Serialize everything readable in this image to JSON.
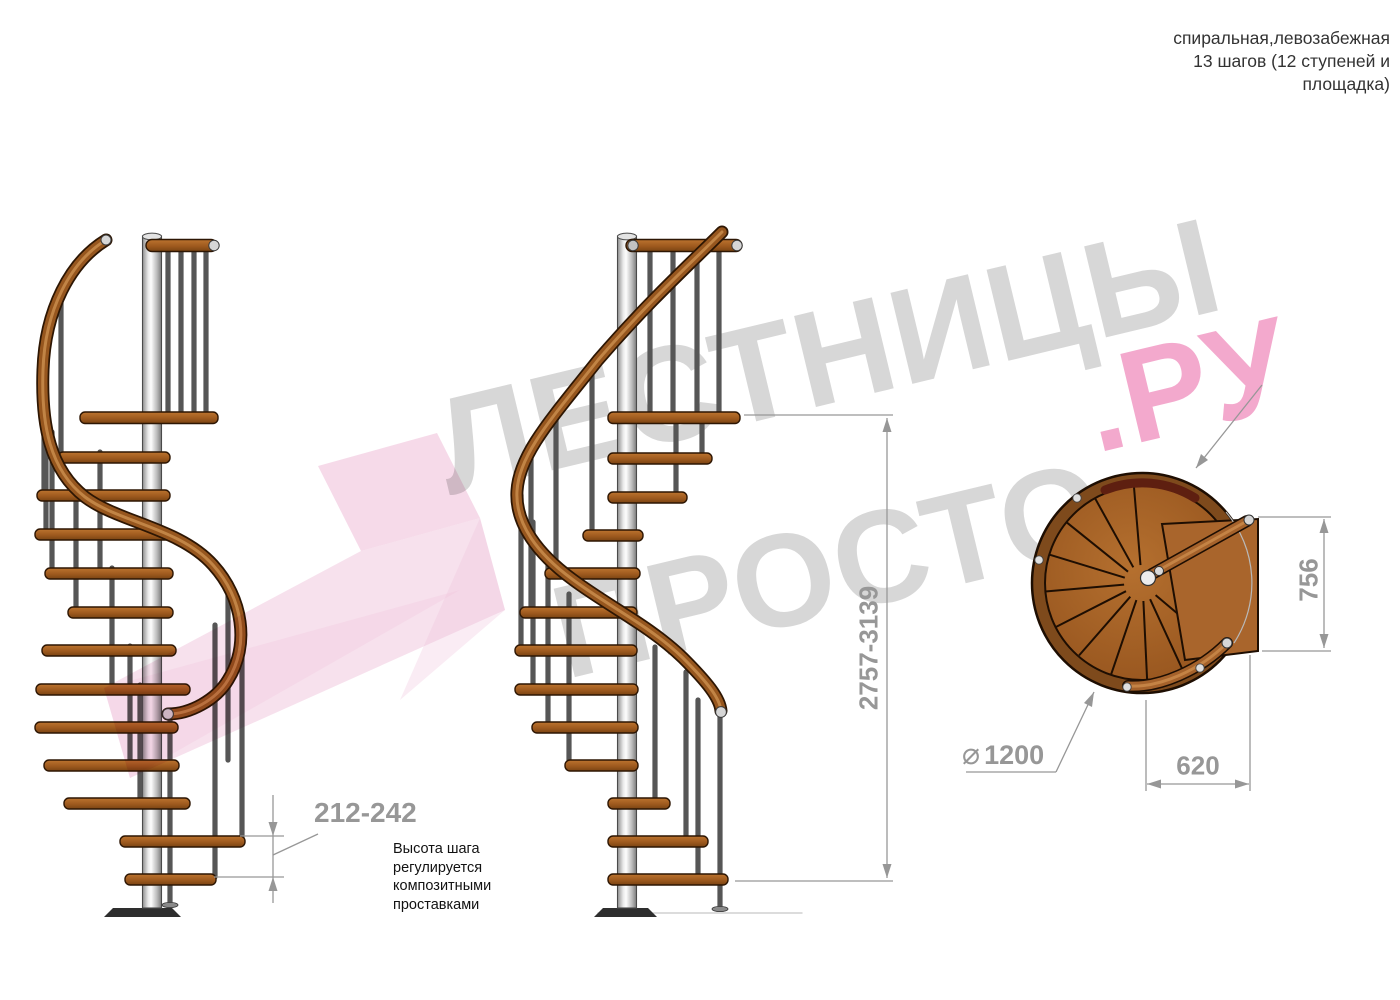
{
  "header": {
    "line1": "спиральная,левозабежная",
    "line2": "13 шагов (12 ступеней и",
    "line3": "площадка)"
  },
  "watermark": {
    "word_top": "ЛЕСТНИЦЫ",
    "word_bottom": "ПРОСТО",
    "word_suffix": ".РУ",
    "gray_color": "#d7d7d7",
    "pink_color": "#f3a9cd",
    "arrow_color": "#f0c3dc"
  },
  "dimensions": {
    "step_height_range": "212-242",
    "total_height_range": "2757-3139",
    "landing_depth": "756",
    "landing_width": "620",
    "diameter_symbol": "⌀",
    "diameter_value": "1200"
  },
  "annotation": {
    "step_height_note": "Высота шага\nрегулируется\nкомпозитными\nпроставками"
  },
  "colors": {
    "wood": "#a5622b",
    "handrail": "#96561e",
    "metal_pole": "#c9c9c9",
    "dimension_gray": "#979797",
    "title_text": "#333333"
  }
}
